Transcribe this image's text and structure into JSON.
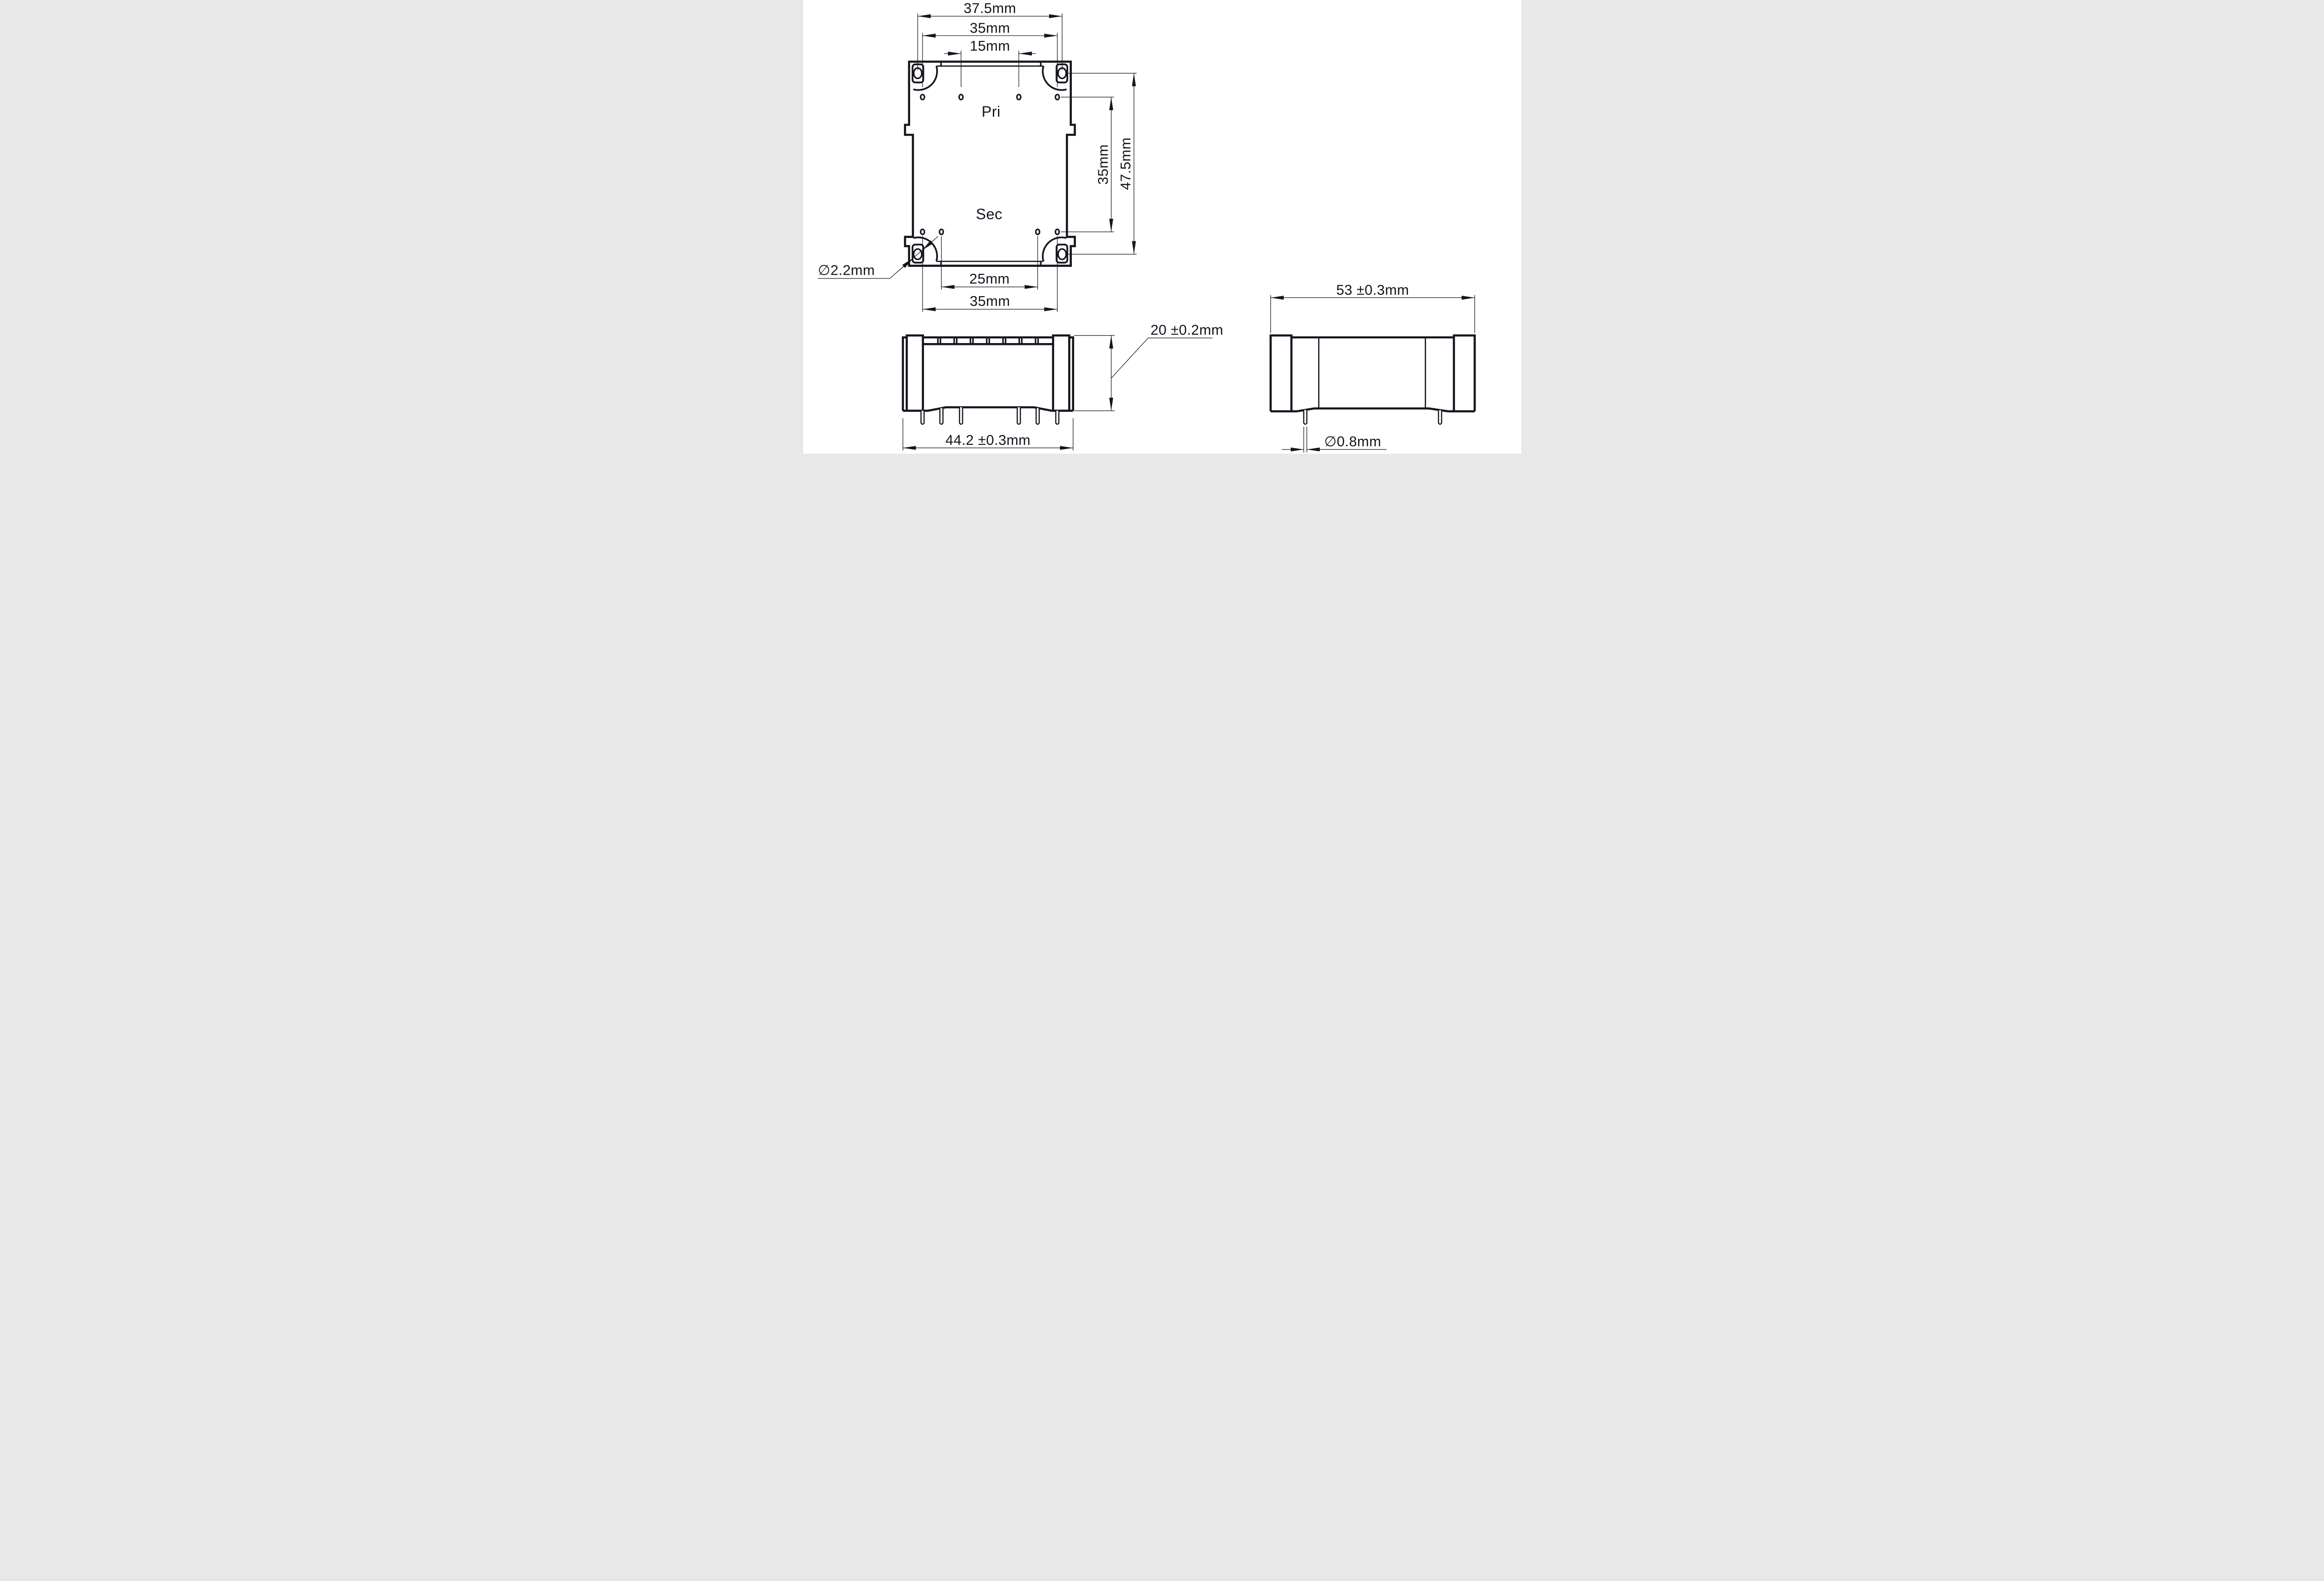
{
  "drawing": {
    "description": "Three-view mechanical dimension drawing of a PCB-mount encapsulated transformer",
    "colors": {
      "ink": "#15151f",
      "background": "#ffffff"
    },
    "top_view": {
      "label_primary": "Pri",
      "label_secondary": "Sec",
      "dim_mount_hole_span": "37.5mm",
      "dim_pri_outer_pin_span": "35mm",
      "dim_pri_inner_pin_span": "15mm",
      "dim_pin_row_span": "35mm",
      "dim_mount_hole_row_span": "47.5mm",
      "dim_mount_hole_dia": "∅2.2mm",
      "dim_sec_inner_pin_span": "25mm",
      "dim_sec_outer_pin_span": "35mm"
    },
    "front_view": {
      "dim_body_width": "44.2 ±0.3mm",
      "dim_body_height": "20 ±0.2mm"
    },
    "side_view": {
      "dim_body_width": "53 ±0.3mm",
      "dim_pin_dia": "∅0.8mm"
    }
  }
}
